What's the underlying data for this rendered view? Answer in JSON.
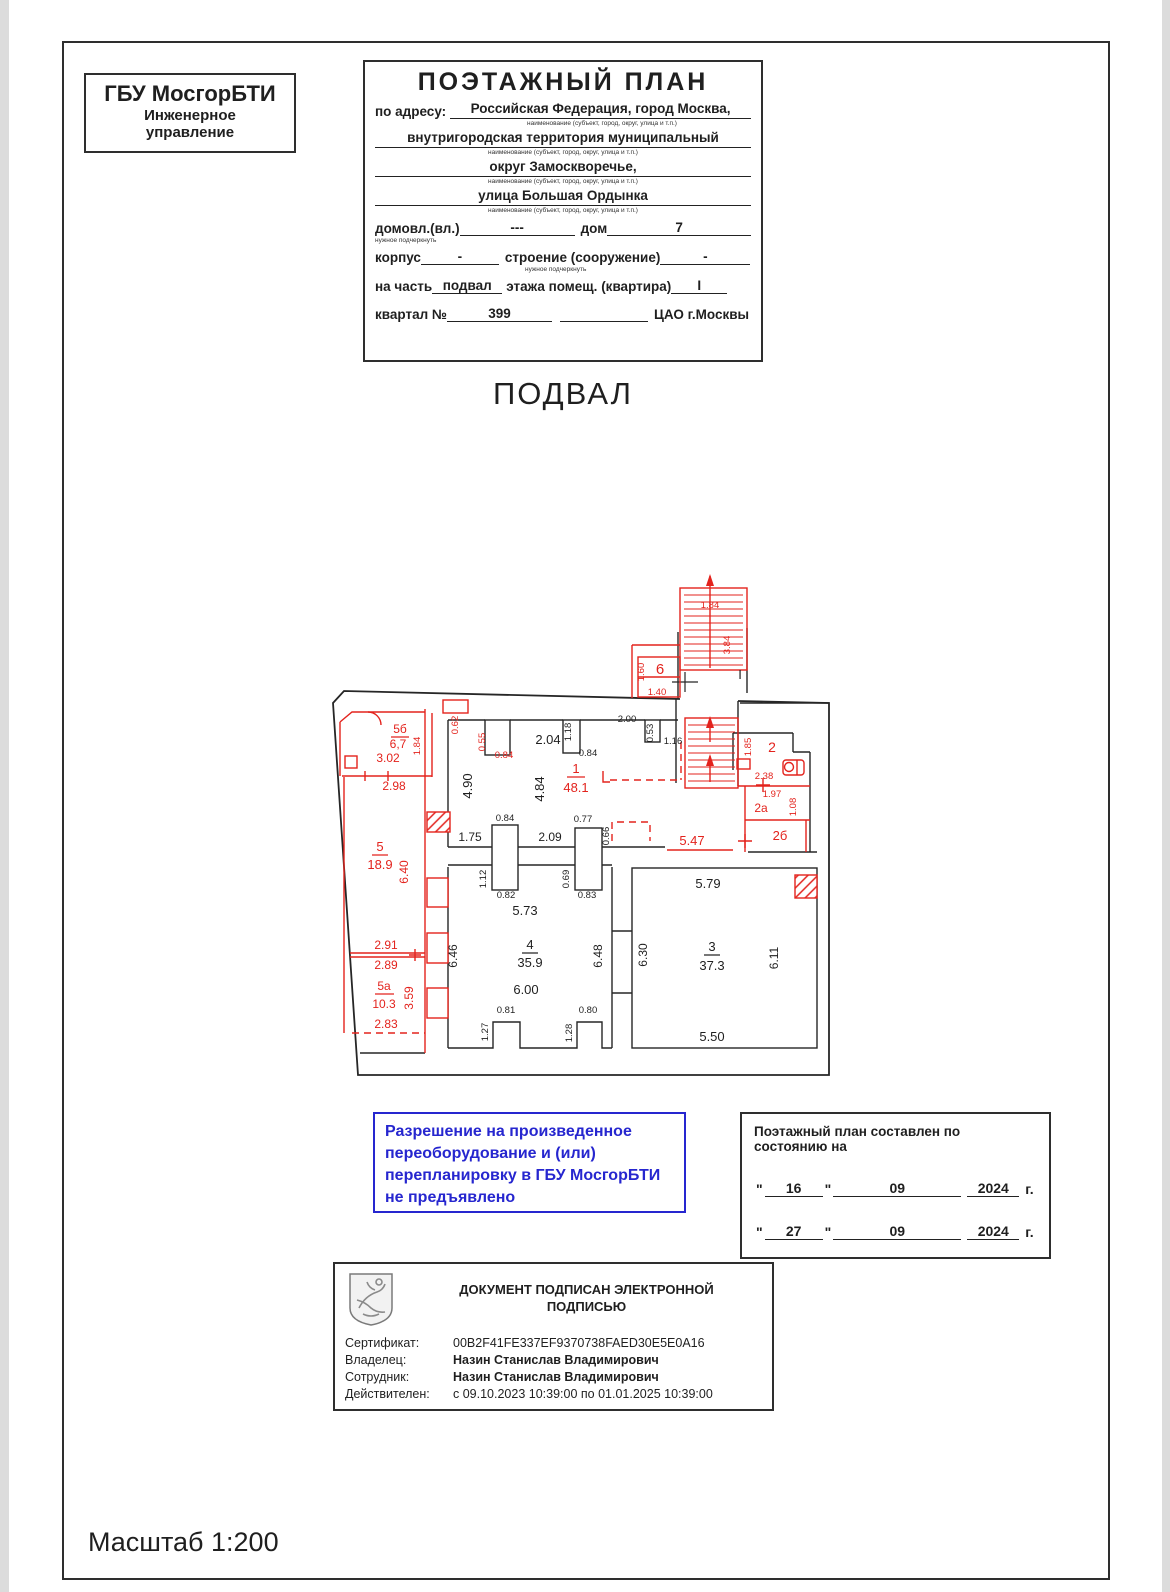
{
  "org_box": {
    "line1": "ГБУ МосгорБТИ",
    "line2": "Инженерное",
    "line3": "управление"
  },
  "header": {
    "title": "ПОЭТАЖНЫЙ ПЛАН",
    "address_label": "по адресу:",
    "address_lines": [
      "Российская Федерация, город Москва,",
      "внутригородская территория муниципальный",
      "округ Замоскворечье,",
      "улица Большая Ордынка"
    ],
    "caption": "наименование (субъект, город, округ, улица и т.п.)",
    "underline_note": "нужное подчеркнуть",
    "fields": {
      "domovl_label": "домовл.(вл.)",
      "domovl_value": "---",
      "dom_label": "дом",
      "dom_value": "7",
      "korpus_label": "корпус",
      "korpus_value": "-",
      "stroenie_label": "строение (сооружение)",
      "stroenie_value": "-",
      "na_chast_label": "на часть",
      "na_chast_value": "подвал",
      "etazh_label": "этажа помещ. (квартира)",
      "etazh_value": "I",
      "kvartal_label": "квартал №",
      "kvartal_value": "399",
      "okrug_value": "ЦАО г.Москвы"
    }
  },
  "floor_title": "ПОДВАЛ",
  "permission": {
    "lines": [
      "Разрешение на произведенное",
      "переоборудование и (или)",
      "перепланировку в ГБУ МосгорБТИ",
      "не предъявлено"
    ]
  },
  "date_box": {
    "title": "Поэтажный план составлен по состоянию на",
    "rows": [
      {
        "day": "16",
        "month": "09",
        "year": "2024",
        "suffix": "г."
      },
      {
        "day": "27",
        "month": "09",
        "year": "2024",
        "suffix": "г."
      }
    ]
  },
  "signature": {
    "title_line1": "ДОКУМЕНТ ПОДПИСАН ЭЛЕКТРОННОЙ",
    "title_line2": "ПОДПИСЬЮ",
    "rows": [
      {
        "label": "Сертификат:",
        "value": "00B2F41FE337EF9370738FAED30E5E0A16",
        "bold": false
      },
      {
        "label": "Владелец:",
        "value": "Назин Станислав Владимирович",
        "bold": true
      },
      {
        "label": "Сотрудник:",
        "value": "Назин Станислав Владимирович",
        "bold": true
      },
      {
        "label": "Действителен:",
        "value": "с 09.10.2023 10:39:00 по 01.01.2025 10:39:00",
        "bold": false
      }
    ]
  },
  "scale_note": "Масштаб 1:200",
  "colors": {
    "red": "#e3231d",
    "blue": "#2626cf",
    "black": "#1f1f1f"
  },
  "plan": {
    "rooms": [
      {
        "number": "1",
        "area": "48.1"
      },
      {
        "number": "2",
        "area": ""
      },
      {
        "number": "2а",
        "area": ""
      },
      {
        "number": "2б",
        "area": ""
      },
      {
        "number": "3",
        "area": "37.3"
      },
      {
        "number": "4",
        "area": "35.9"
      },
      {
        "number": "5",
        "area": "18.9"
      },
      {
        "number": "5а",
        "area": "10.3"
      },
      {
        "number": "5б",
        "area": "6,7"
      },
      {
        "number": "6",
        "area": ""
      }
    ],
    "labels": [
      {
        "t": "1.84",
        "x": 390,
        "y": 48,
        "c": "r"
      },
      {
        "t": "3.84",
        "x": 410,
        "y": 85,
        "c": "r",
        "r": 1
      },
      {
        "t": "6",
        "x": 340,
        "y": 114,
        "c": "r",
        "s": 15
      },
      {
        "t": "1.60",
        "x": 324,
        "y": 112,
        "c": "r",
        "r": 1
      },
      {
        "t": "1.40",
        "x": 337,
        "y": 135,
        "c": "r"
      },
      {
        "t": "I",
        "x": 420,
        "y": 119,
        "s": 13,
        "f": 1
      },
      {
        "t": "0.62",
        "x": 138,
        "y": 165,
        "c": "r",
        "r": 1
      },
      {
        "t": "0.55",
        "x": 165,
        "y": 182,
        "c": "r",
        "r": 1
      },
      {
        "t": "0.84",
        "x": 184,
        "y": 198,
        "c": "r"
      },
      {
        "t": "2.04",
        "x": 228,
        "y": 184,
        "s": 13
      },
      {
        "t": "1.18",
        "x": 251,
        "y": 172,
        "r": 1
      },
      {
        "t": "0.84",
        "x": 268,
        "y": 196
      },
      {
        "t": "2.00",
        "x": 307,
        "y": 162
      },
      {
        "t": "0.53",
        "x": 333,
        "y": 173,
        "r": 1
      },
      {
        "t": "1.16",
        "x": 353,
        "y": 184
      },
      {
        "t": "4.90",
        "x": 152,
        "y": 226,
        "r": 1,
        "s": 13
      },
      {
        "t": "4.84",
        "x": 224,
        "y": 229,
        "r": 1,
        "s": 13
      },
      {
        "t": "1",
        "x": 256,
        "y": 213,
        "c": "r",
        "s": 13
      },
      {
        "t": "48.1",
        "x": 256,
        "y": 232,
        "c": "r",
        "s": 13
      },
      {
        "t": "5б",
        "x": 80,
        "y": 173,
        "c": "r",
        "s": 12
      },
      {
        "t": "6,7",
        "x": 78,
        "y": 188,
        "c": "r",
        "s": 12
      },
      {
        "t": "3.02",
        "x": 68,
        "y": 202,
        "c": "r",
        "s": 12
      },
      {
        "t": "2.98",
        "x": 74,
        "y": 230,
        "c": "r",
        "s": 12
      },
      {
        "t": "1.84",
        "x": 100,
        "y": 186,
        "c": "r",
        "r": 1
      },
      {
        "t": "2",
        "x": 452,
        "y": 192,
        "c": "r",
        "s": 14
      },
      {
        "t": "1.85",
        "x": 431,
        "y": 187,
        "c": "r",
        "r": 1
      },
      {
        "t": "2.38",
        "x": 444,
        "y": 219,
        "c": "r"
      },
      {
        "t": "1.97",
        "x": 452,
        "y": 237,
        "c": "r"
      },
      {
        "t": "2а",
        "x": 441,
        "y": 252,
        "c": "r",
        "s": 12
      },
      {
        "t": "1.08",
        "x": 476,
        "y": 247,
        "c": "r",
        "r": 1
      },
      {
        "t": "2б",
        "x": 460,
        "y": 280,
        "c": "r",
        "s": 13
      },
      {
        "t": "1.75",
        "x": 150,
        "y": 281,
        "s": 12
      },
      {
        "t": "0.84",
        "x": 185,
        "y": 261
      },
      {
        "t": "2.09",
        "x": 230,
        "y": 281,
        "s": 12
      },
      {
        "t": "0.77",
        "x": 263,
        "y": 262
      },
      {
        "t": "0.66",
        "x": 289,
        "y": 276,
        "r": 1
      },
      {
        "t": "5.47",
        "x": 372,
        "y": 285,
        "c": "r",
        "s": 13
      },
      {
        "t": "1.12",
        "x": 166,
        "y": 319,
        "r": 1
      },
      {
        "t": "0.82",
        "x": 186,
        "y": 338
      },
      {
        "t": "0.69",
        "x": 249,
        "y": 319,
        "r": 1
      },
      {
        "t": "0.83",
        "x": 267,
        "y": 338
      },
      {
        "t": "5",
        "x": 60,
        "y": 291,
        "c": "r",
        "s": 13
      },
      {
        "t": "18.9",
        "x": 60,
        "y": 309,
        "c": "r",
        "s": 13
      },
      {
        "t": "6.40",
        "x": 88,
        "y": 312,
        "c": "r",
        "r": 1,
        "s": 12
      },
      {
        "t": "2.91",
        "x": 66,
        "y": 389,
        "c": "r",
        "s": 12
      },
      {
        "t": "2.89",
        "x": 66,
        "y": 409,
        "c": "r",
        "s": 12
      },
      {
        "t": "5а",
        "x": 64,
        "y": 430,
        "c": "r",
        "s": 12
      },
      {
        "t": "10.3",
        "x": 64,
        "y": 448,
        "c": "r",
        "s": 12
      },
      {
        "t": "3.59",
        "x": 93,
        "y": 438,
        "c": "r",
        "r": 1,
        "s": 12
      },
      {
        "t": "2.83",
        "x": 66,
        "y": 468,
        "c": "r",
        "s": 12
      },
      {
        "t": "5.73",
        "x": 205,
        "y": 355,
        "s": 13
      },
      {
        "t": "4",
        "x": 210,
        "y": 389,
        "s": 13
      },
      {
        "t": "35.9",
        "x": 210,
        "y": 407,
        "s": 13
      },
      {
        "t": "6.00",
        "x": 206,
        "y": 434,
        "s": 13
      },
      {
        "t": "6.46",
        "x": 137,
        "y": 396,
        "r": 1,
        "s": 12
      },
      {
        "t": "6.48",
        "x": 282,
        "y": 396,
        "r": 1,
        "s": 12
      },
      {
        "t": "0.81",
        "x": 186,
        "y": 453
      },
      {
        "t": "1.27",
        "x": 168,
        "y": 472,
        "r": 1
      },
      {
        "t": "0.80",
        "x": 268,
        "y": 453
      },
      {
        "t": "1.28",
        "x": 252,
        "y": 473,
        "r": 1
      },
      {
        "t": "5.79",
        "x": 388,
        "y": 328,
        "s": 13
      },
      {
        "t": "3",
        "x": 392,
        "y": 391,
        "s": 13
      },
      {
        "t": "37.3",
        "x": 392,
        "y": 410,
        "s": 13
      },
      {
        "t": "6.30",
        "x": 327,
        "y": 395,
        "r": 1,
        "s": 12
      },
      {
        "t": "6.11",
        "x": 458,
        "y": 398,
        "r": 1,
        "s": 12
      },
      {
        "t": "5.50",
        "x": 392,
        "y": 481,
        "s": 13
      }
    ]
  }
}
